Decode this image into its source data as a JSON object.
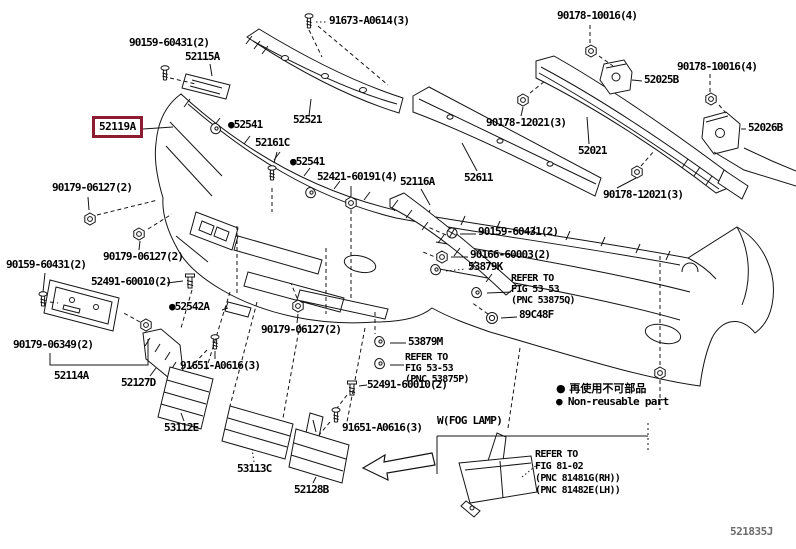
{
  "doc": {
    "drawing_number": "521835J",
    "highlight_color": "#8e1b30",
    "line_color": "#141414"
  },
  "selected": {
    "part_number": "52119A"
  },
  "legend": {
    "jp": "● 再使用不可部品",
    "en": "● Non-reusable part"
  },
  "fog": {
    "header": "W(FOG LAMP)",
    "refer": "REFER TO\nFIG 81-02\n(PNC 81481G(RH))\n(PNC 81482E(LH))"
  },
  "icons": {
    "nut": "hex-nut",
    "screw": "machine-screw",
    "bolt": "shoulder-bolt",
    "clip": "retainer-clip",
    "grommet": "grommet",
    "washer_screw": "washer-head-screw"
  },
  "labels": [
    {
      "name": "label-90159-60431-a",
      "text": "90159-60431(2)",
      "x": 129,
      "y": 37
    },
    {
      "name": "label-52115a",
      "text": "52115A",
      "x": 185,
      "y": 51
    },
    {
      "name": "label-91673-a0614",
      "text": "91673-A0614(3)",
      "x": 329,
      "y": 15
    },
    {
      "name": "label-90178-10016-a",
      "text": "90178-10016(4)",
      "x": 557,
      "y": 10
    },
    {
      "name": "label-90178-10016-b",
      "text": "90178-10016(4)",
      "x": 677,
      "y": 61
    },
    {
      "name": "label-52025b",
      "text": "52025B",
      "x": 644,
      "y": 74
    },
    {
      "name": "label-52026b",
      "text": "52026B",
      "x": 748,
      "y": 122
    },
    {
      "name": "label-90178-12021-a",
      "text": "90178-12021(3)",
      "x": 486,
      "y": 117
    },
    {
      "name": "label-52021",
      "text": "52021",
      "x": 578,
      "y": 145
    },
    {
      "name": "label-90178-12021-b",
      "text": "90178-12021(3)",
      "x": 603,
      "y": 189
    },
    {
      "name": "label-52611",
      "text": "52611",
      "x": 464,
      "y": 172
    },
    {
      "name": "label-52116a",
      "text": "52116A",
      "x": 400,
      "y": 176
    },
    {
      "name": "label-52521",
      "text": "52521",
      "x": 293,
      "y": 114
    },
    {
      "name": "label-52541-a",
      "text": "●52541",
      "x": 228,
      "y": 119
    },
    {
      "name": "label-52161c",
      "text": "52161C",
      "x": 255,
      "y": 137
    },
    {
      "name": "label-52541-b",
      "text": "●52541",
      "x": 290,
      "y": 156
    },
    {
      "name": "label-52421-60191",
      "text": "52421-60191(4)",
      "x": 317,
      "y": 171
    },
    {
      "name": "label-90179-06127-a",
      "text": "90179-06127(2)",
      "x": 52,
      "y": 182
    },
    {
      "name": "label-90179-06127-b",
      "text": "90179-06127(2)",
      "x": 103,
      "y": 251
    },
    {
      "name": "label-90159-60431-b",
      "text": "90159-60431(2)",
      "x": 6,
      "y": 259
    },
    {
      "name": "label-52491-60010-a",
      "text": "52491-60010(2)",
      "x": 91,
      "y": 276
    },
    {
      "name": "label-52542a",
      "text": "●52542A",
      "x": 169,
      "y": 301
    },
    {
      "name": "label-90179-06127-c",
      "text": "90179-06127(2)",
      "x": 261,
      "y": 324
    },
    {
      "name": "label-90179-06349",
      "text": "90179-06349(2)",
      "x": 13,
      "y": 339
    },
    {
      "name": "label-52114a",
      "text": "52114A",
      "x": 54,
      "y": 370
    },
    {
      "name": "label-52127d",
      "text": "52127D",
      "x": 121,
      "y": 377
    },
    {
      "name": "label-91651-a0616-a",
      "text": "91651-A0616(3)",
      "x": 180,
      "y": 360
    },
    {
      "name": "label-53112e",
      "text": "53112E",
      "x": 164,
      "y": 422
    },
    {
      "name": "label-53113c",
      "text": "53113C",
      "x": 237,
      "y": 463
    },
    {
      "name": "label-52128b",
      "text": "52128B",
      "x": 294,
      "y": 484
    },
    {
      "name": "label-91651-a0616-b",
      "text": "91651-A0616(3)",
      "x": 342,
      "y": 422
    },
    {
      "name": "label-52491-60010-b",
      "text": "52491-60010(2)",
      "x": 367,
      "y": 379
    },
    {
      "name": "label-53879m",
      "text": "53879M",
      "x": 408,
      "y": 336
    },
    {
      "name": "note-53875p",
      "cls": "note",
      "text": "REFER TO\nFIG 53-53\n(PNC 53875P)",
      "x": 405,
      "y": 352
    },
    {
      "name": "label-90159-60431-c",
      "text": "90159-60431(2)",
      "x": 478,
      "y": 226
    },
    {
      "name": "label-90166-60003",
      "text": "90166-60003(2)",
      "x": 470,
      "y": 249
    },
    {
      "name": "label-53879k",
      "text": "53879K",
      "x": 468,
      "y": 261
    },
    {
      "name": "note-53875q",
      "cls": "note",
      "text": "REFER TO\nFIG 53 53\n(PNC 53875Q)",
      "x": 511,
      "y": 273
    },
    {
      "name": "label-89c48f",
      "text": "89C48F",
      "x": 519,
      "y": 309
    }
  ]
}
